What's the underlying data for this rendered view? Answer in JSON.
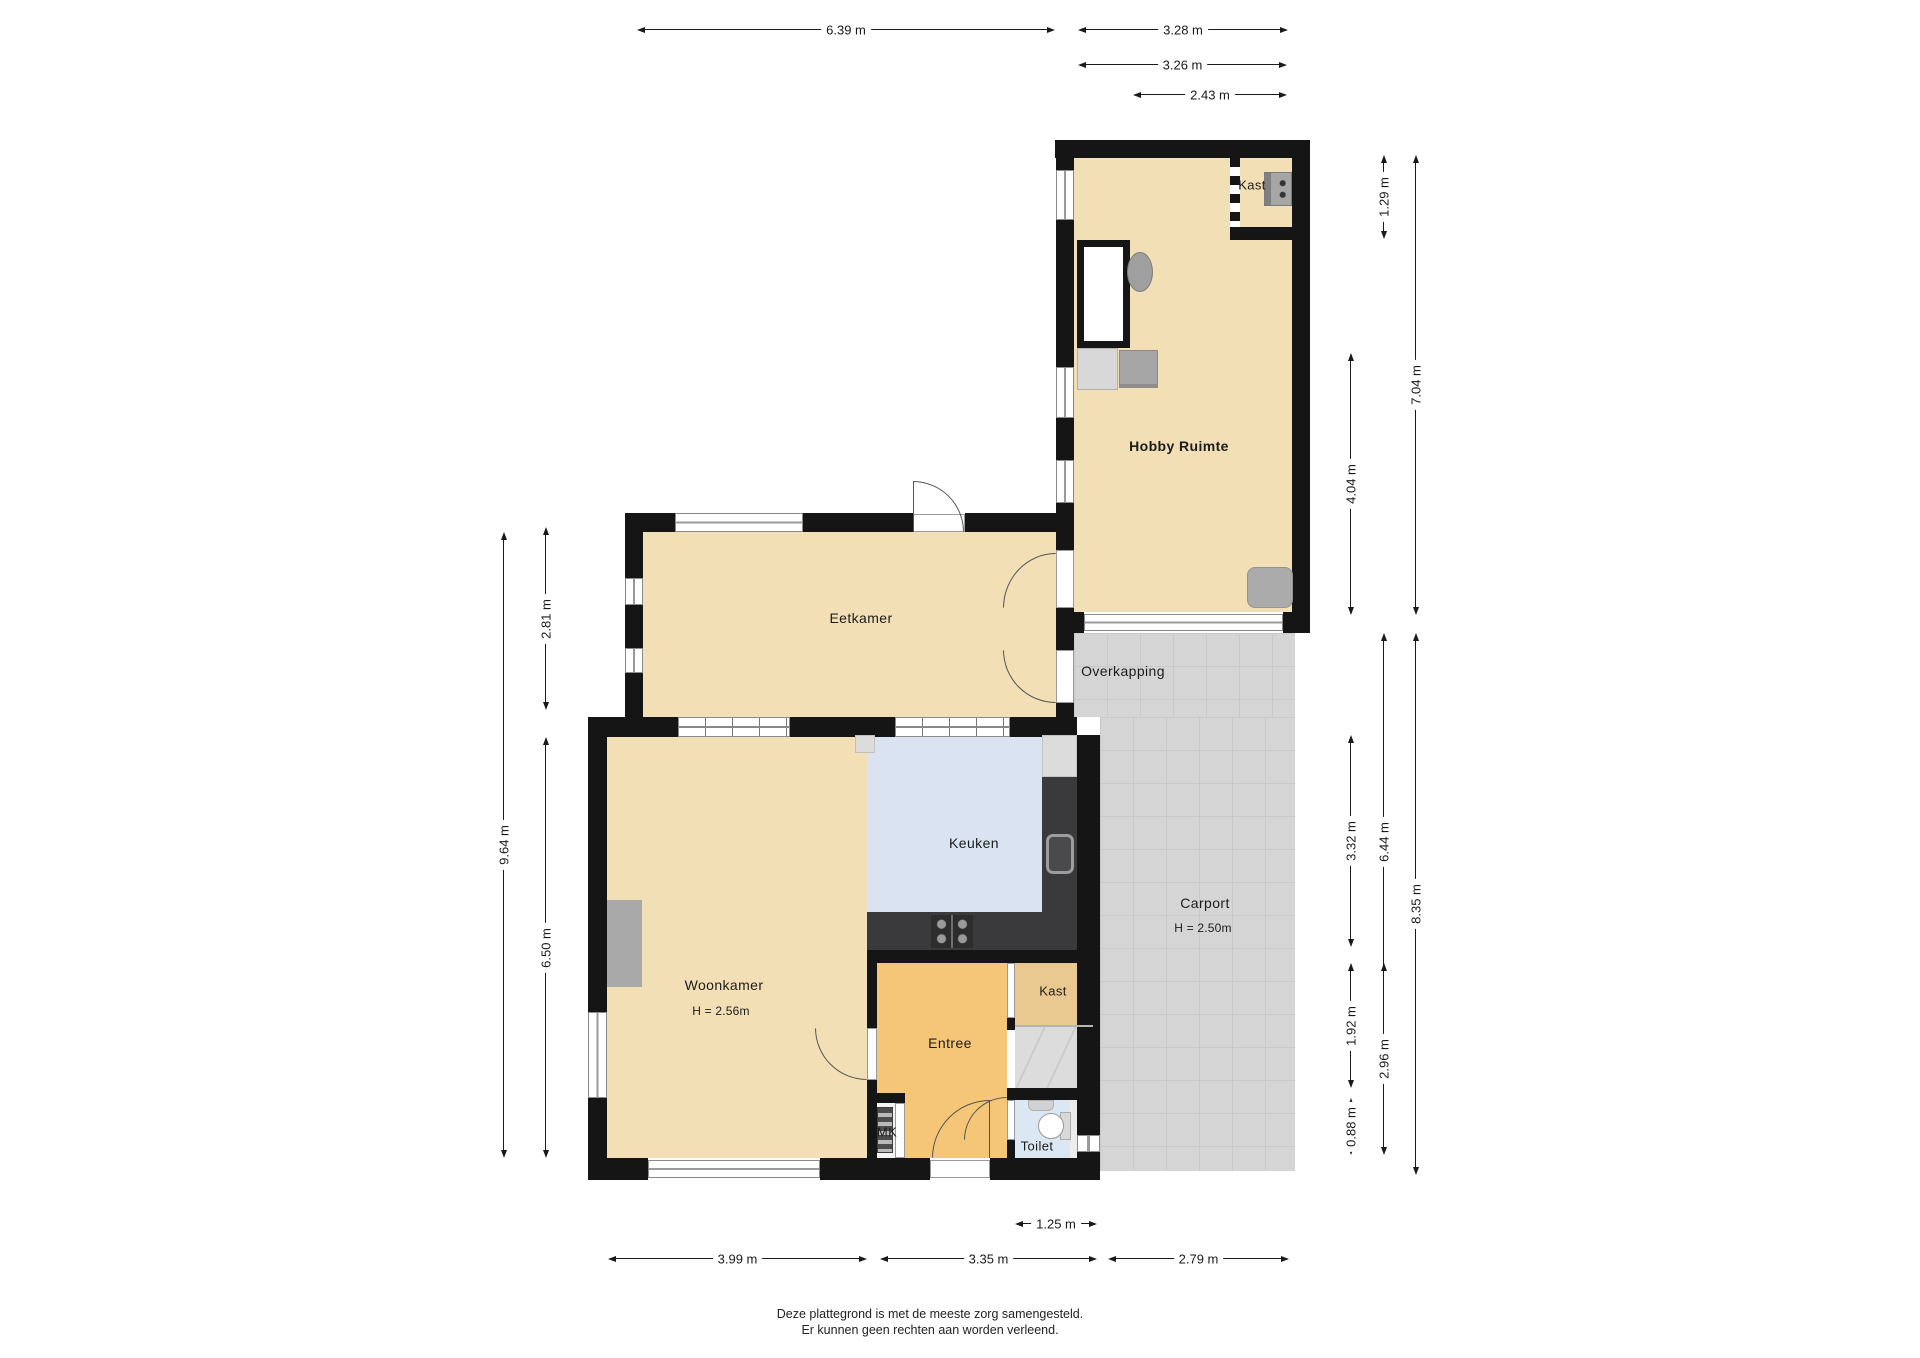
{
  "title": "Plattegrond begane grond",
  "rooms": {
    "hobby": "Hobby Ruimte",
    "kast_top": "Kast",
    "eetkamer": "Eetkamer",
    "overkapping": "Overkapping",
    "keuken": "Keuken",
    "woonkamer": "Woonkamer",
    "woonkamer_height": "H = 2.56m",
    "carport": "Carport",
    "carport_height": "H = 2.50m",
    "kast_bottom": "Kast",
    "entree": "Entree",
    "mk": "MK",
    "toilet": "Toilet"
  },
  "dims": {
    "d639": "6.39 m",
    "d328": "3.28 m",
    "d326": "3.26 m",
    "d243": "2.43 m",
    "d125": "1.25 m",
    "d399": "3.99 m",
    "d335": "3.35 m",
    "d279": "2.79 m",
    "d964": "9.64 m",
    "d281": "2.81 m",
    "d650": "6.50 m",
    "d129": "1.29 m",
    "d704": "7.04 m",
    "d404": "4.04 m",
    "d644": "6.44 m",
    "d332": "3.32 m",
    "d835": "8.35 m",
    "d192": "1.92 m",
    "d296": "2.96 m",
    "d088": "0.88 m"
  },
  "footer": {
    "line1": "Deze plattegrond is met de meeste zorg samengesteld.",
    "line2": "Er kunnen geen rechten aan worden verleend."
  },
  "colors": {
    "wall": "#151515",
    "room_beige": "#f3dfb6",
    "kitchen_blue": "#d9e3f1",
    "entree_orange": "#f5c677",
    "closet_tan": "#e9c98f",
    "toilet_blue": "#dbe7f2",
    "paving_grey": "#d5d5d5",
    "counter_dark": "#3a3a3c"
  }
}
